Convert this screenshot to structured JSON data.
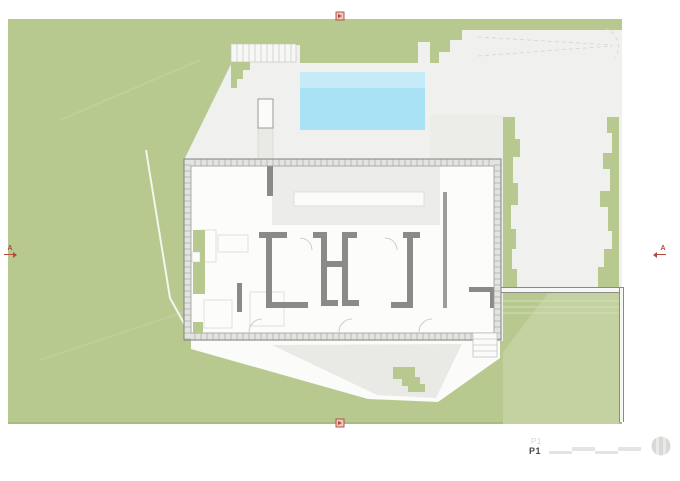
{
  "document": {
    "sheet_label": "P1",
    "sheet_label_ghost": "P1"
  },
  "section_markers": {
    "left": {
      "label": "A"
    },
    "right": {
      "label": "A"
    },
    "top": {
      "label": ""
    },
    "bottom": {
      "label": ""
    }
  },
  "scale_bar": {
    "segments": 4
  },
  "colors": {
    "lawn": "#b7c98f",
    "lawn_dark": "#a9bb80",
    "lawn_light": "#c4d1a1",
    "paving": "#f0f0ee",
    "paving_shade": "#e9e9e6",
    "paving_bright": "#fbfbfa",
    "pool": "#a9e1f5",
    "pool_shallow": "#c6ebf8",
    "wall": "#8a8a87",
    "floor": "#fcfcfb",
    "interior_shade": "#ececea",
    "marker_red": "#b5493d",
    "scalebar": "#e4e4e2",
    "compass_gray": "#d8d8d6",
    "text_dark": "#4a4a48",
    "text_ghost": "#d6d6d4"
  }
}
